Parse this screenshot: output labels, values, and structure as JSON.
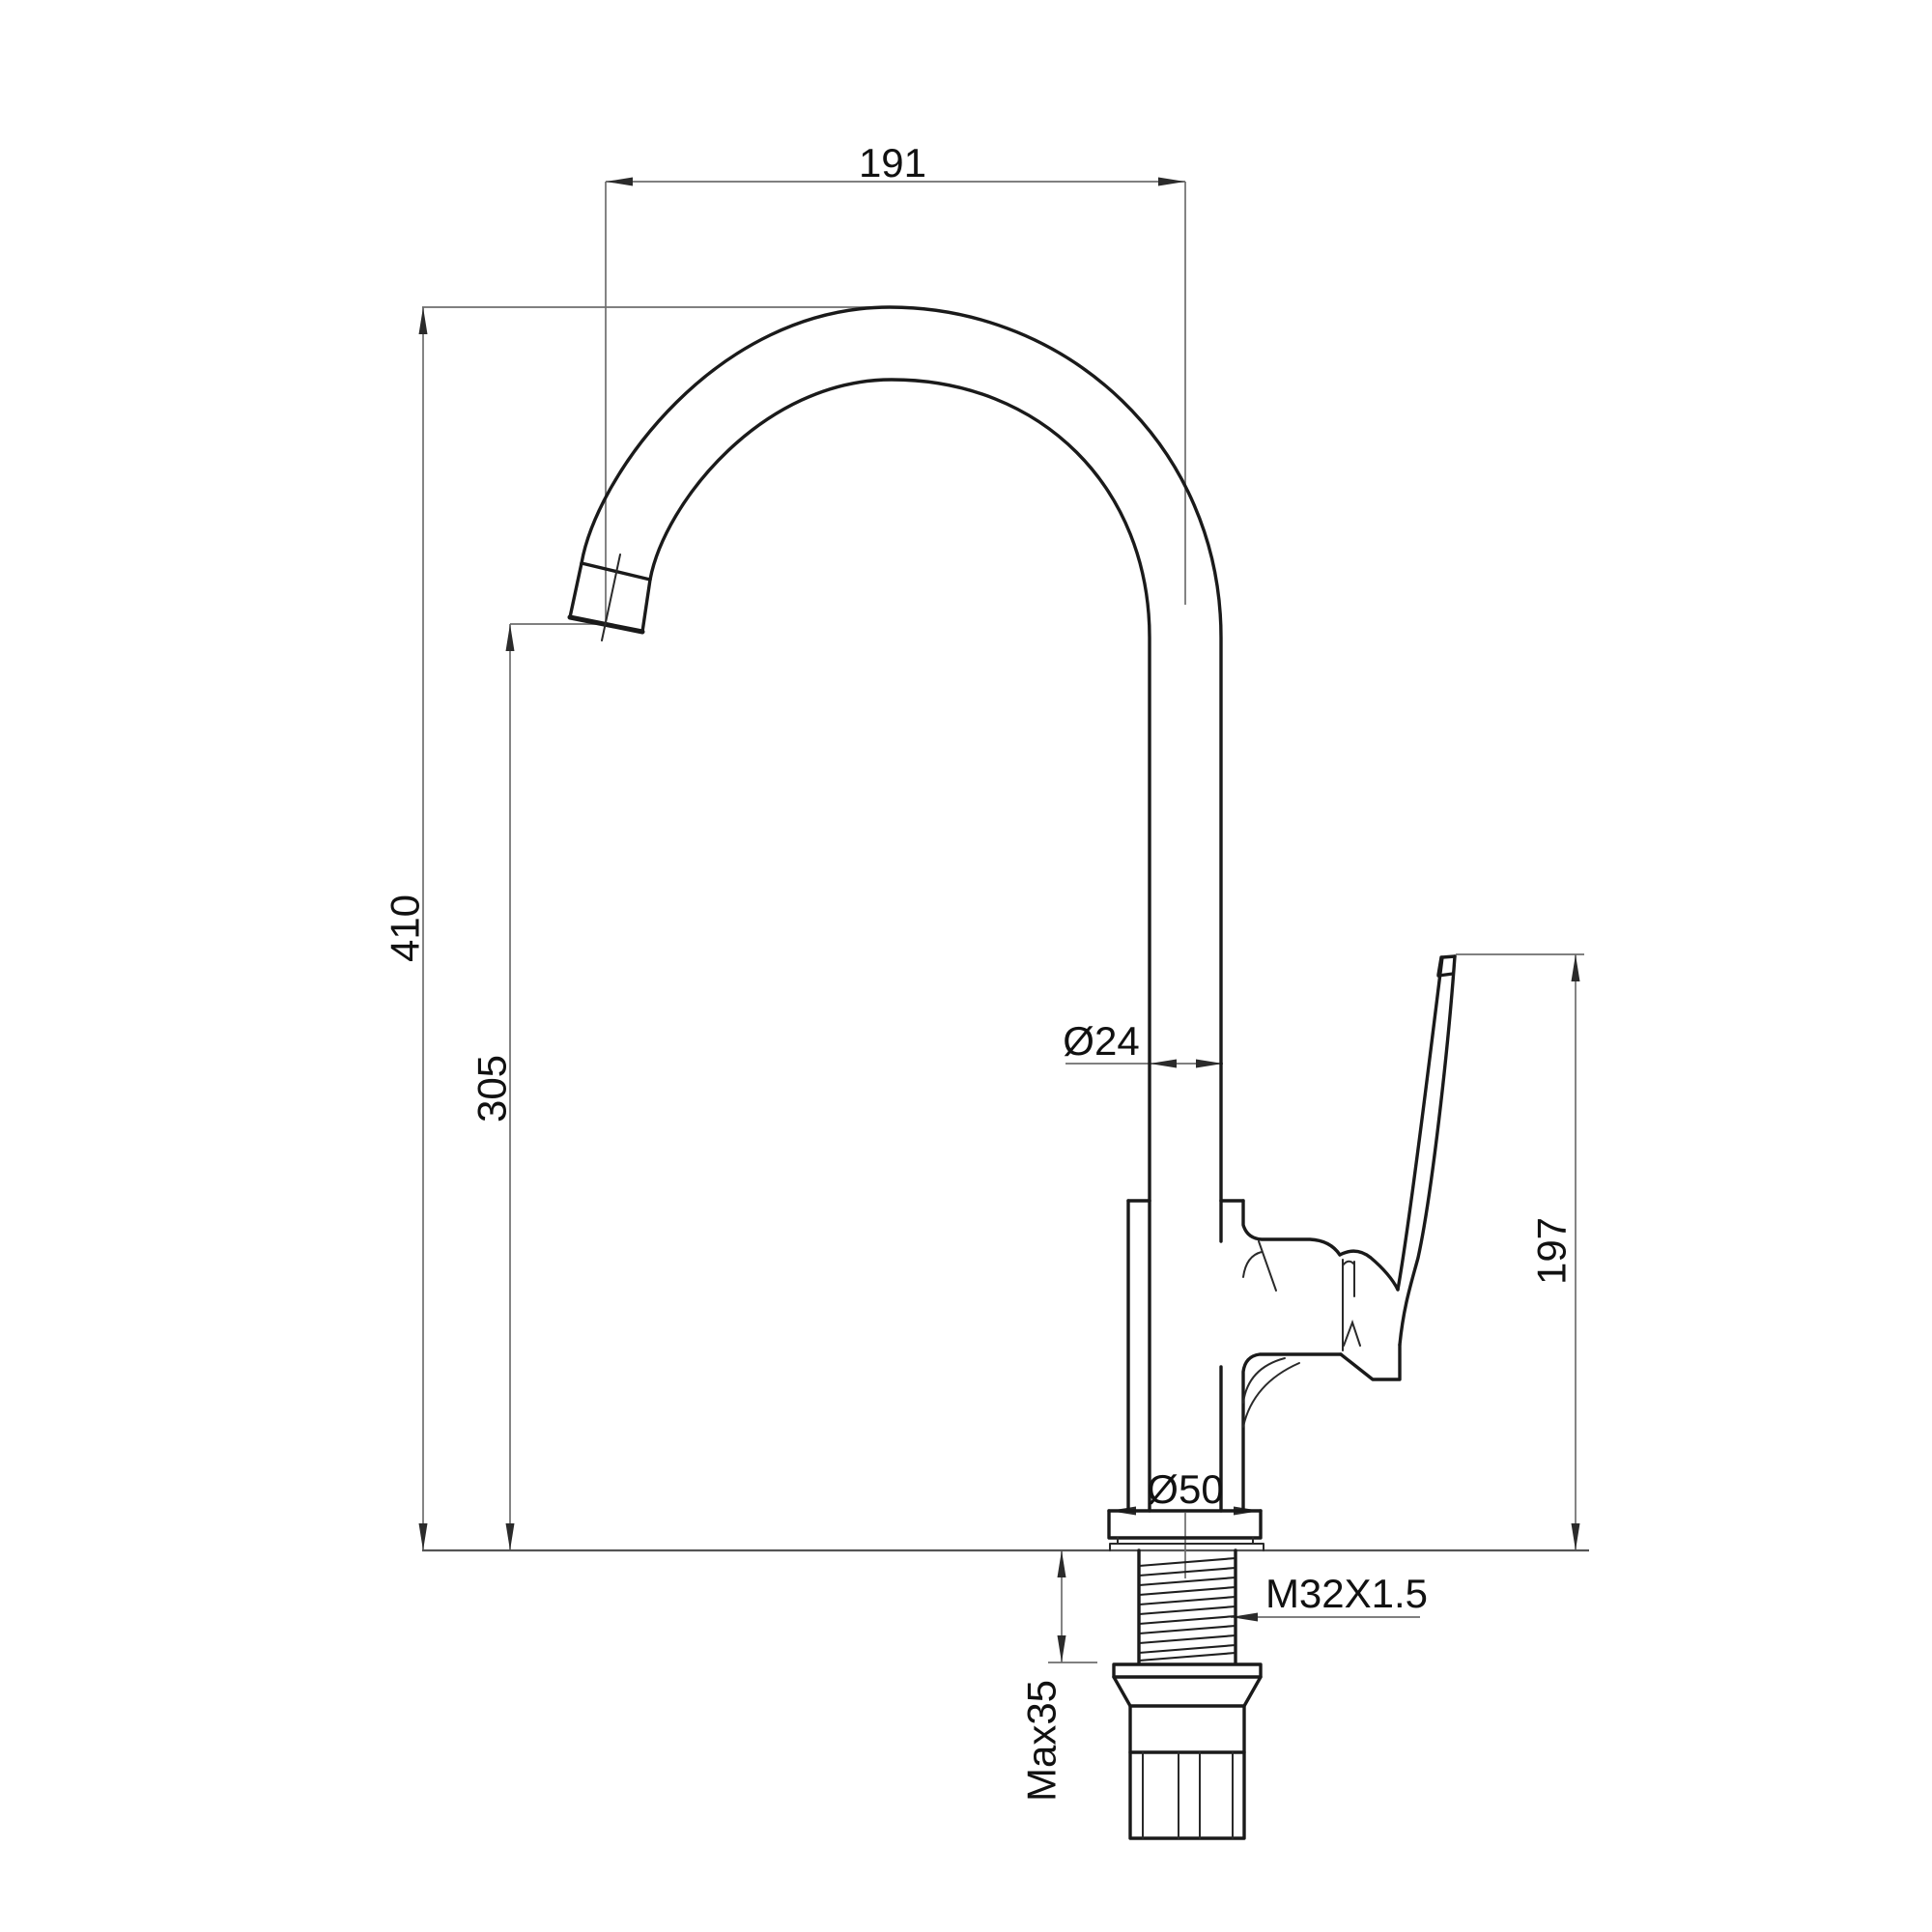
{
  "drawing": {
    "subject": "Kitchen faucet dimensional technical drawing, side elevation",
    "background_color": "#ffffff",
    "outline_color": "#1a1a1a",
    "dimension_line_color": "#6e6e6e",
    "text_color": "#111111",
    "dimensions": {
      "spout_reach": "191",
      "overall_height": "410",
      "spout_outlet_height": "305",
      "spout_tube_diameter": "Ø24",
      "handle_height": "197",
      "base_flange_diameter": "Ø50",
      "mounting_thread": "M32X1.5",
      "max_counter_thickness": "Max35"
    }
  }
}
